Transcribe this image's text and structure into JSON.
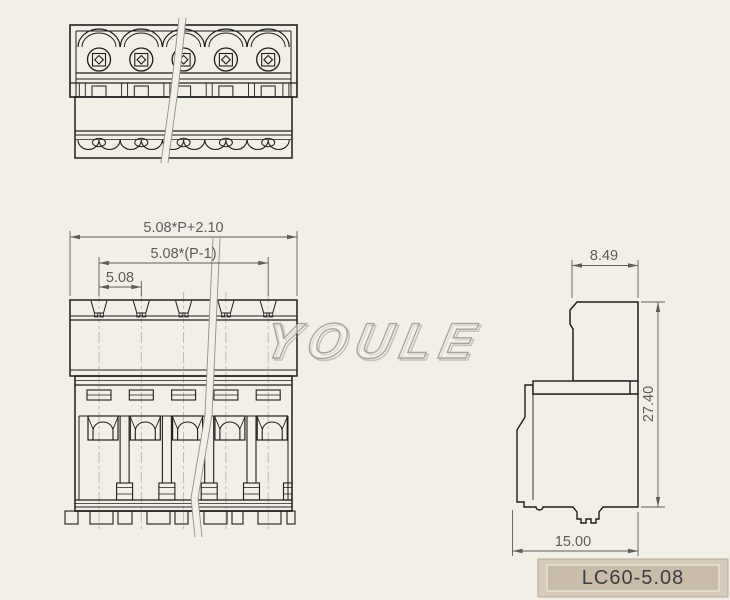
{
  "part": {
    "positions_shown": 5,
    "watermark": "YOULE"
  },
  "dimensions": {
    "overall_width": "5.08*P+2.10",
    "pitch_span": "5.08*(P-1)",
    "pitch": "5.08",
    "plug_width": "8.49",
    "height": "27.40",
    "base_width": "15.00"
  },
  "title_block": {
    "model": "LC60-5.08"
  },
  "colors": {
    "background": "#f2efe6",
    "line": "#1e1e1e",
    "dimension_gray": "#5c5c5c",
    "centerline": "#b9b6ad",
    "watermark_stroke": "#a9a59a",
    "title_block_outer": "#d7ccba",
    "title_block_inner": "#c9bdaa",
    "title_text": "#3f3f3f"
  }
}
